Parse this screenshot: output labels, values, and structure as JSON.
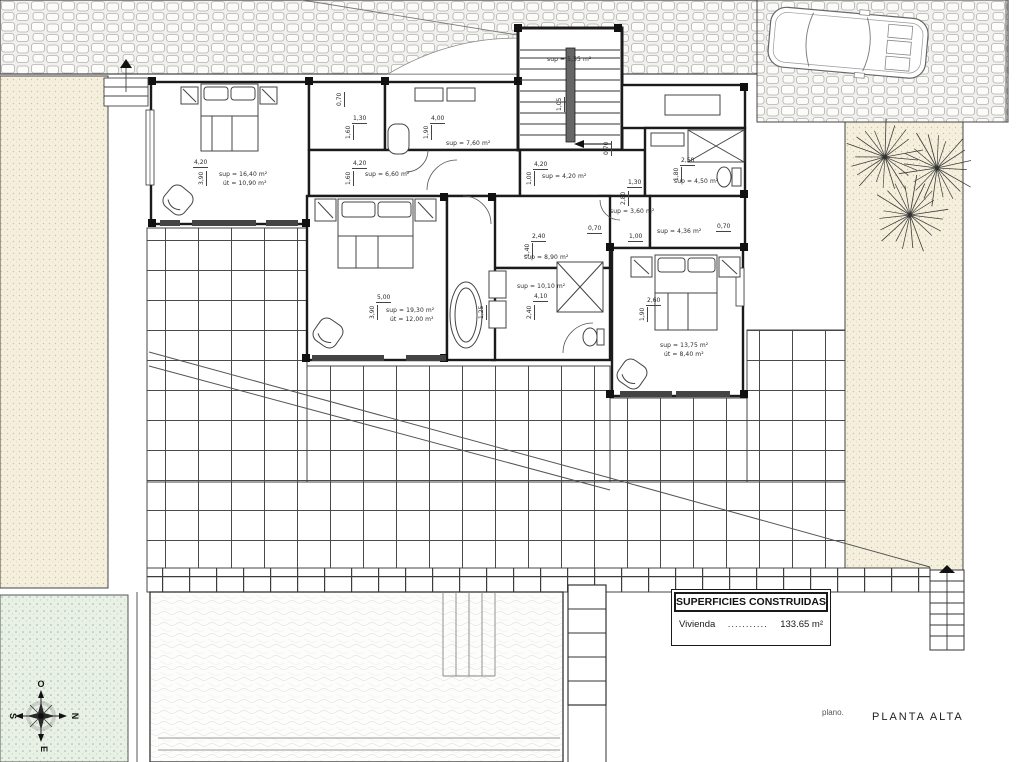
{
  "title_block": {
    "plano_label": "plano.",
    "plan_name": "PLANTA ALTA"
  },
  "legend": {
    "header": "SUPERFICIES CONSTRUIDAS",
    "rows": [
      {
        "label": "Vivienda",
        "dots": "...........",
        "value": "133.65 m²"
      }
    ]
  },
  "compass": {
    "top": "O",
    "right": "N",
    "bottom": "E",
    "left": "S"
  },
  "colors": {
    "wall": "#1b1b1b",
    "line": "#555555",
    "sand_dot": "#cfc3a2",
    "grass_dot": "#9db89d"
  },
  "annotations": {
    "areas": [
      {
        "x": 219,
        "y": 172,
        "t": "sup = 16,40 m²"
      },
      {
        "x": 223,
        "y": 181,
        "t": "út = 10,90 m²"
      },
      {
        "x": 446,
        "y": 141,
        "t": "sup = 7,60 m²"
      },
      {
        "x": 365,
        "y": 172,
        "t": "sup = 6,60 m²"
      },
      {
        "x": 547,
        "y": 57,
        "t": "sup = 5,55 m²"
      },
      {
        "x": 542,
        "y": 174,
        "t": "sup = 4,20 m²"
      },
      {
        "x": 674,
        "y": 179,
        "t": "sup = 4,50 m²"
      },
      {
        "x": 610,
        "y": 209,
        "t": "sup = 3,60 m²"
      },
      {
        "x": 657,
        "y": 229,
        "t": "sup = 4,36 m²"
      },
      {
        "x": 524,
        "y": 255,
        "t": "sup = 8,90 m²"
      },
      {
        "x": 517,
        "y": 284,
        "t": "sup = 10,10 m²"
      },
      {
        "x": 386,
        "y": 308,
        "t": "sup = 19,30 m²"
      },
      {
        "x": 390,
        "y": 317,
        "t": "út = 12,00 m²"
      },
      {
        "x": 660,
        "y": 343,
        "t": "sup = 13,75 m²"
      },
      {
        "x": 664,
        "y": 352,
        "t": "út = 8,40 m²"
      }
    ],
    "dims": [
      {
        "x": 193,
        "y": 160,
        "t": "4,20"
      },
      {
        "x": 199,
        "y": 186,
        "t": "3,90",
        "v": 1
      },
      {
        "x": 337,
        "y": 107,
        "t": "0,70",
        "v": 1
      },
      {
        "x": 352,
        "y": 116,
        "t": "1,30"
      },
      {
        "x": 346,
        "y": 140,
        "t": "1,60",
        "v": 1
      },
      {
        "x": 430,
        "y": 116,
        "t": "4,00"
      },
      {
        "x": 424,
        "y": 140,
        "t": "1,90",
        "v": 1
      },
      {
        "x": 352,
        "y": 161,
        "t": "4,20"
      },
      {
        "x": 346,
        "y": 186,
        "t": "1,60",
        "v": 1
      },
      {
        "x": 533,
        "y": 162,
        "t": "4,20"
      },
      {
        "x": 527,
        "y": 186,
        "t": "1,00",
        "v": 1
      },
      {
        "x": 557,
        "y": 112,
        "t": "1,05",
        "v": 1
      },
      {
        "x": 680,
        "y": 158,
        "t": "2,50"
      },
      {
        "x": 674,
        "y": 182,
        "t": "1,80",
        "v": 1
      },
      {
        "x": 604,
        "y": 156,
        "t": "0,70",
        "v": 1
      },
      {
        "x": 587,
        "y": 226,
        "t": "0,70"
      },
      {
        "x": 716,
        "y": 224,
        "t": "0,70"
      },
      {
        "x": 627,
        "y": 180,
        "t": "1,30"
      },
      {
        "x": 621,
        "y": 206,
        "t": "2,80",
        "v": 1
      },
      {
        "x": 628,
        "y": 234,
        "t": "1,00"
      },
      {
        "x": 531,
        "y": 234,
        "t": "2,40"
      },
      {
        "x": 525,
        "y": 258,
        "t": "1,40",
        "v": 1
      },
      {
        "x": 533,
        "y": 294,
        "t": "4,10"
      },
      {
        "x": 527,
        "y": 320,
        "t": "2,40",
        "v": 1
      },
      {
        "x": 376,
        "y": 295,
        "t": "5,00"
      },
      {
        "x": 370,
        "y": 320,
        "t": "3,90",
        "v": 1
      },
      {
        "x": 479,
        "y": 320,
        "t": "1,25",
        "v": 1
      },
      {
        "x": 646,
        "y": 298,
        "t": "2,60"
      },
      {
        "x": 640,
        "y": 322,
        "t": "1,90",
        "v": 1
      }
    ]
  }
}
